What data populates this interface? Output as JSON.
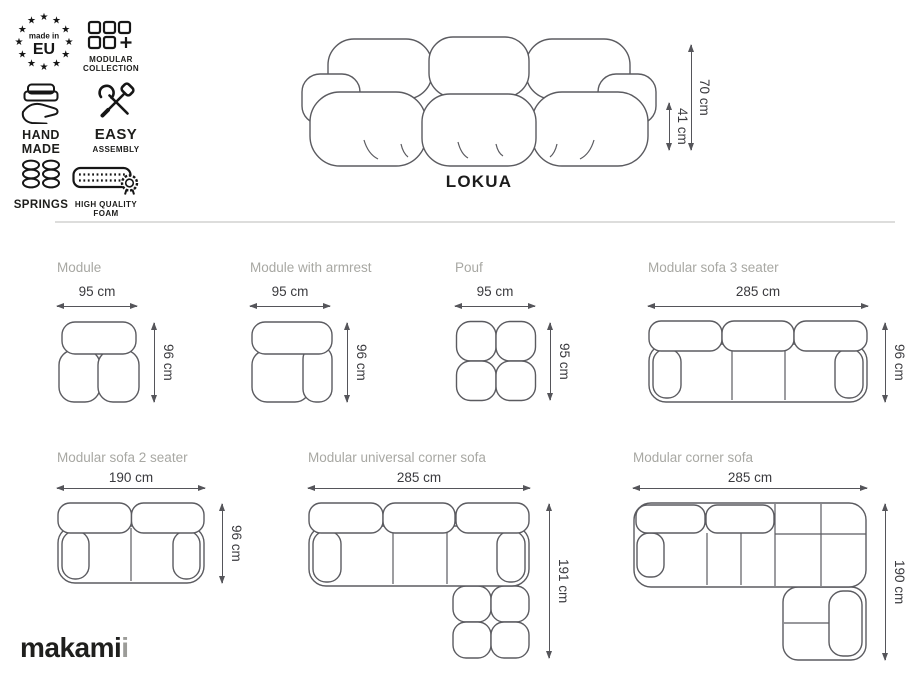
{
  "badges": {
    "made_in_eu": {
      "top": "made in",
      "main": "EU"
    },
    "modular_collection": {
      "line1": "MODULAR",
      "line2": "COLLECTION"
    },
    "hand_made": {
      "line1": "HAND",
      "line2": "MADE"
    },
    "easy_assembly": {
      "line1": "EASY",
      "line2": "ASSEMBLY"
    },
    "springs": {
      "label": "SPRINGS"
    },
    "high_quality_foam": {
      "line1": "HIGH QUALITY",
      "line2": "FOAM"
    }
  },
  "hero": {
    "product_name": "LOKUA",
    "total_height": "70 cm",
    "seat_height": "41 cm"
  },
  "figures": [
    {
      "title": "Module",
      "width": "95 cm",
      "depth": "96 cm"
    },
    {
      "title": "Module with armrest",
      "width": "95 cm",
      "depth": "96 cm"
    },
    {
      "title": "Pouf",
      "width": "95 cm",
      "depth": "95 cm"
    },
    {
      "title": "Modular sofa 3 seater",
      "width": "285 cm",
      "depth": "96 cm"
    },
    {
      "title": "Modular sofa 2 seater",
      "width": "190 cm",
      "depth": "96 cm"
    },
    {
      "title": "Modular universal corner sofa",
      "width": "285 cm",
      "depth": "191 cm"
    },
    {
      "title": "Modular corner sofa",
      "width": "285 cm",
      "depth": "190 cm"
    }
  ],
  "logo": {
    "prefix": "makam",
    "i_black": "i",
    "i_gray": "i"
  },
  "colors": {
    "ink": "#1d1d1b",
    "line_art": "#5b5b60",
    "arrow": "#55555a",
    "muted_title": "#a8a8a3",
    "divider": "#dddddc",
    "logo_accent": "#9c9c98"
  }
}
